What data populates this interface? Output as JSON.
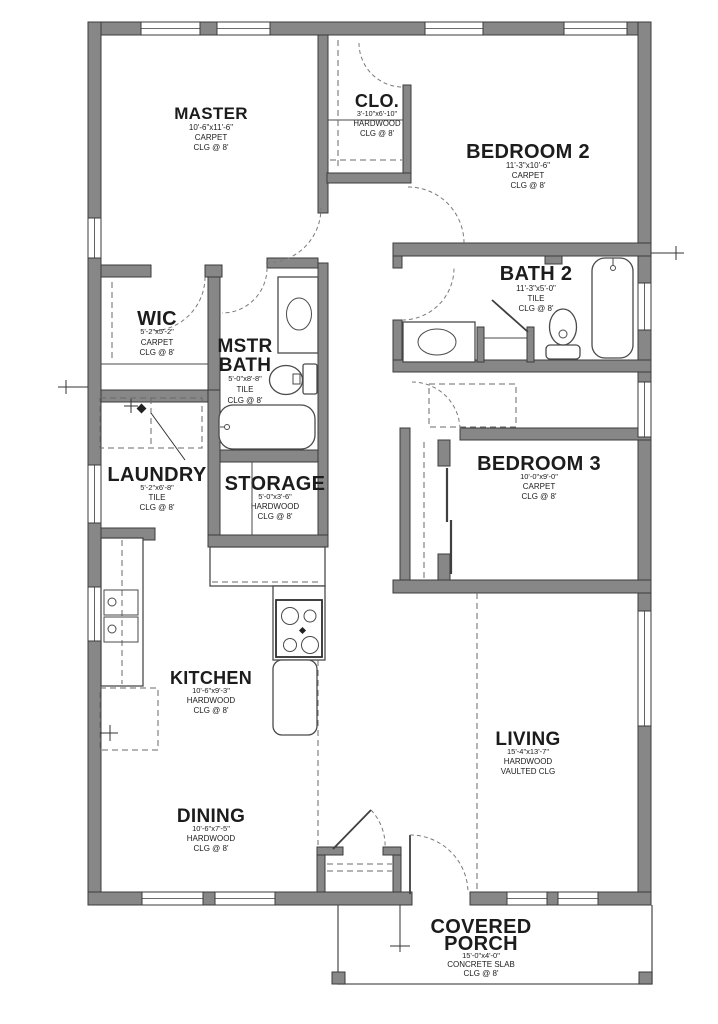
{
  "rooms": {
    "master": {
      "name": "MASTER",
      "dims": "10'-6\"x11'-6\"",
      "floor": "CARPET",
      "ceiling": "CLG @ 8'"
    },
    "clo": {
      "name": "CLO.",
      "dims": "3'-10\"x6'-10\"",
      "floor": "HARDWOOD",
      "ceiling": "CLG @ 8'"
    },
    "bedroom2": {
      "name": "BEDROOM 2",
      "dims": "11'-3\"x10'-6\"",
      "floor": "CARPET",
      "ceiling": "CLG @ 8'"
    },
    "wic": {
      "name": "WIC",
      "dims": "5'-2\"x5'-2\"",
      "floor": "CARPET",
      "ceiling": "CLG @ 8'"
    },
    "mstr_bath": {
      "name_line1": "MSTR",
      "name_line2": "BATH",
      "dims": "5'-0\"x8'-8\"",
      "floor": "TILE",
      "ceiling": "CLG @ 8'"
    },
    "bath2": {
      "name": "BATH 2",
      "dims": "11'-3\"x5'-0\"",
      "floor": "TILE",
      "ceiling": "CLG @ 8'"
    },
    "laundry": {
      "name": "LAUNDRY",
      "dims": "5'-2\"x6'-8\"",
      "floor": "TILE",
      "ceiling": "CLG @ 8'"
    },
    "storage": {
      "name": "STORAGE",
      "dims": "5'-0\"x3'-6\"",
      "floor": "HARDWOOD",
      "ceiling": "CLG @ 8'"
    },
    "bedroom3": {
      "name": "BEDROOM 3",
      "dims": "10'-0\"x9'-0\"",
      "floor": "CARPET",
      "ceiling": "CLG @ 8'"
    },
    "kitchen": {
      "name": "KITCHEN",
      "dims": "10'-6\"x9'-3\"",
      "floor": "HARDWOOD",
      "ceiling": "CLG @ 8'"
    },
    "dining": {
      "name": "DINING",
      "dims": "10'-6\"x7'-5\"",
      "floor": "HARDWOOD",
      "ceiling": "CLG @ 8'"
    },
    "living": {
      "name": "LIVING",
      "dims": "15'-4\"x13'-7\"",
      "floor": "HARDWOOD",
      "ceiling": "VAULTED CLG"
    },
    "porch": {
      "name_line1": "COVERED",
      "name_line2": "PORCH",
      "dims": "15'-0\"x4'-0\"",
      "floor": "CONCRETE SLAB",
      "ceiling": "CLG @ 8'"
    }
  },
  "colors": {
    "wall_fill": "#878787",
    "wall_outline": "#3b3b3b",
    "line": "#4a4a4a",
    "dash": "#6a6a6a",
    "text": "#1c1c1c",
    "background": "#ffffff"
  }
}
